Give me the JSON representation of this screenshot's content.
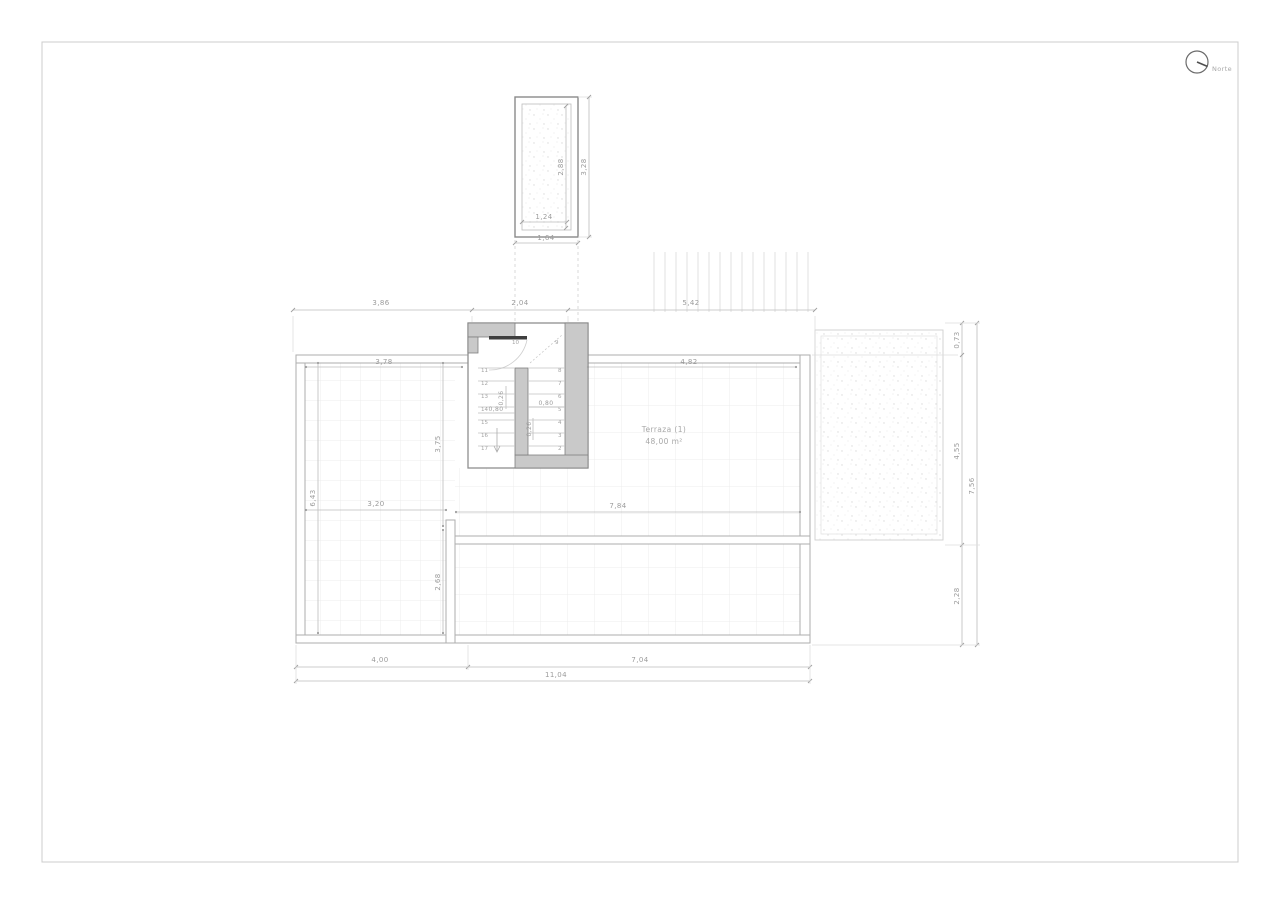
{
  "drawing_title": "Planta de cubierta / terraza",
  "north": {
    "label": "Norte"
  },
  "room": {
    "name": "Terraza (1)",
    "area": "48,00 m²"
  },
  "chimney": {
    "inner_height": "2,88",
    "outer_height": "3,28",
    "inner_width": "1,24",
    "outer_width": "1,64"
  },
  "dims": {
    "top_chain": [
      "3,86",
      "2,04",
      "5,42"
    ],
    "interior_top": [
      "3,78",
      "4,82"
    ],
    "left": {
      "height": "6,43",
      "width": "3,20",
      "upper": "3,75",
      "lower": "2,68"
    },
    "middle": "7,84",
    "bottom_chain": [
      "4,00",
      "7,04"
    ],
    "bottom_total": "11,04",
    "right_chain": [
      "0,73",
      "4,55",
      "2,28"
    ],
    "right_total": "7,56"
  },
  "stair": {
    "dim_tread_left": "0,26",
    "dim_width_left": "0,80",
    "dim_tread_right": "0,26",
    "dim_width_right": "0,80",
    "steps_left": [
      "11",
      "12",
      "13",
      "14",
      "15",
      "16",
      "17"
    ],
    "steps_right": [
      "8",
      "7",
      "6",
      "5",
      "4",
      "3",
      "2"
    ],
    "landing_left": "10",
    "landing_right": "9"
  },
  "colors": {
    "wall_fill": "#c9c9c9",
    "line_gray": "#bdbdbd",
    "text_gray": "#9b9b9b",
    "paper_border": "#cccccc"
  }
}
